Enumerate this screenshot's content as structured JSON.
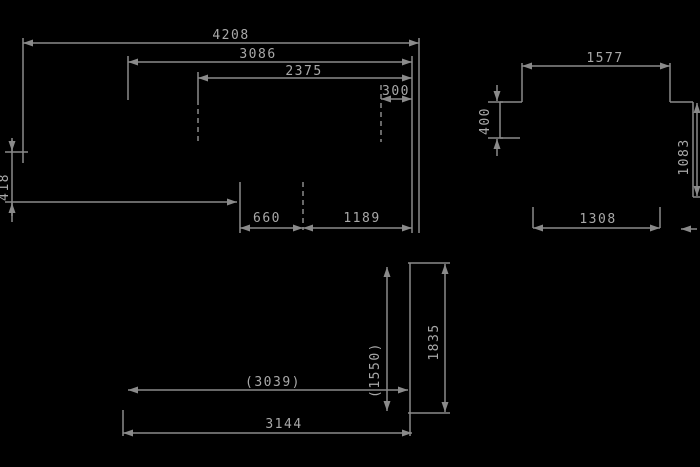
{
  "drawing": {
    "background": "#000000",
    "line_color": "#8a8a8a",
    "text_color": "#a8a8a8",
    "side_view": {
      "overall_length": "4208",
      "body_length": "3086",
      "inner_length": "2375",
      "rear_offset": "300",
      "front_height": "418",
      "axle_gap": "660",
      "rear_gap": "1189"
    },
    "end_view": {
      "top_width": "1577",
      "notch_height": "400",
      "side_height": "1083",
      "bottom_width": "1308"
    },
    "underside_view": {
      "inner_span": "(3039)",
      "overall_span": "3144",
      "inner_height": "(1550)",
      "overall_height": "1835"
    }
  }
}
